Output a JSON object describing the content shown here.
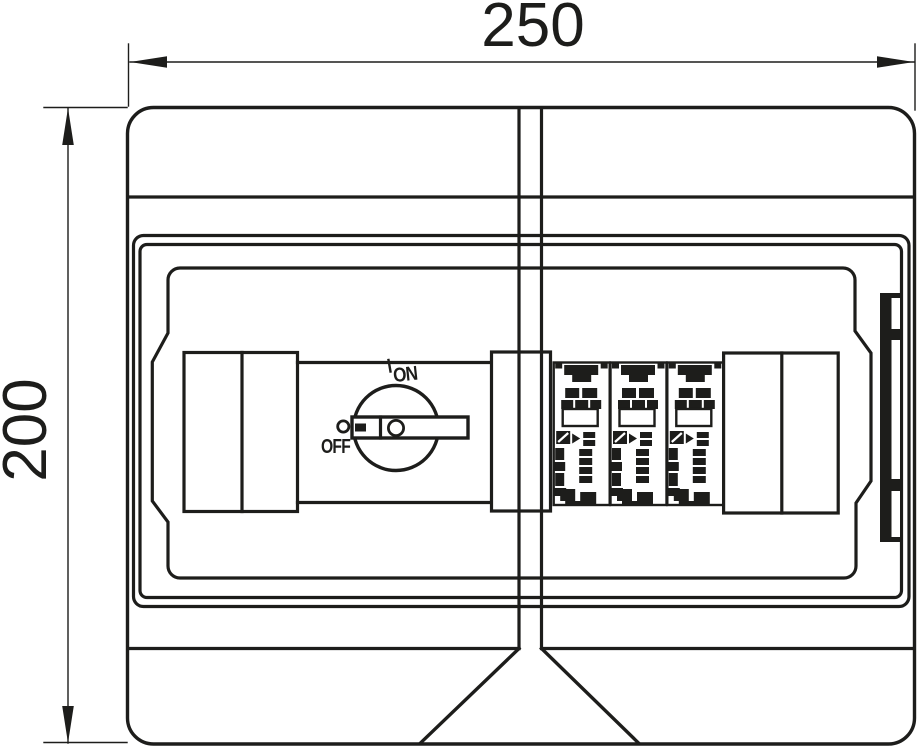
{
  "drawing": {
    "dimension_width": "250",
    "dimension_height": "200",
    "switch": {
      "on_label": "ON",
      "off_label": "OFF"
    },
    "spd_module_count": 3,
    "colors": {
      "ink": "#1d1d1b",
      "paper": "#ffffff"
    }
  }
}
